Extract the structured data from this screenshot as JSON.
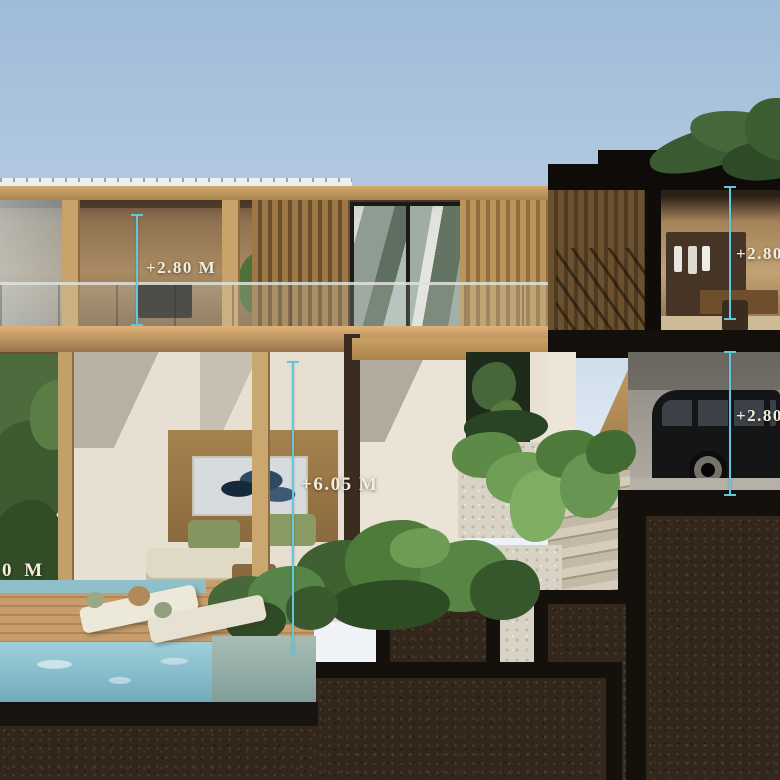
{
  "annotations": {
    "upper_left": {
      "label": "+2.80 M"
    },
    "upper_right": {
      "label": "+2.80"
    },
    "overall_height": {
      "label": "+6.05 M"
    },
    "garage_level": {
      "label": "+2.80"
    },
    "ground_level": {
      "label": "0 M"
    }
  },
  "colors": {
    "dimension_line": "#65c5d9",
    "dimension_text": "#f5eddc",
    "sky_top": "#9fbbd9",
    "sky_horizon": "#f2f5f8",
    "soil": "#33261b",
    "section_cut_black": "#14100c",
    "wood_fascia": "#c9a267",
    "pool_water": "#8ec4d2",
    "foliage_green": "#4f7038",
    "white_wall": "#e8e1d4"
  }
}
